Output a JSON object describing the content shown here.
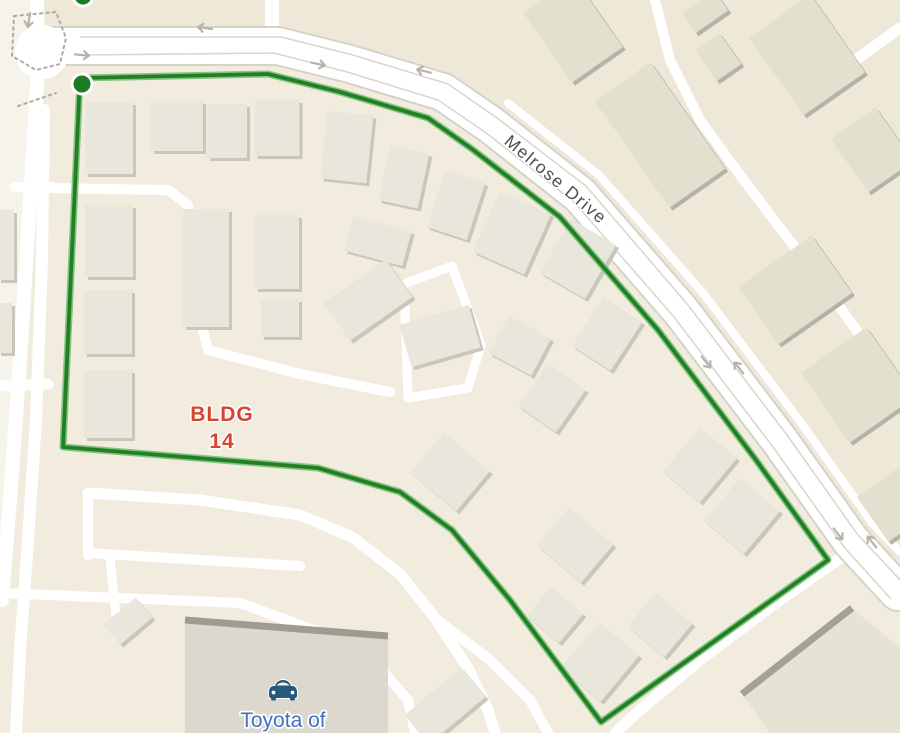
{
  "map": {
    "labels": {
      "street": {
        "text": "Melrose Drive"
      },
      "building_line1": "BLDG",
      "building_line2": "14",
      "poi": "Toyota of"
    },
    "colors": {
      "base": "#f2ecdf",
      "parcel_ne": "#eee8d9",
      "parcel_left": "#f6f3ea",
      "road_fill": "#ffffff",
      "road_casing": "#d5d2c7",
      "lane_line": "#dad7cd",
      "building_fill": "#e9e6db",
      "building_shadow": "#c9c6ba",
      "building_ne_fill": "#e4e0d0",
      "building_ne_shadow": "#b6b3a6",
      "big_building_fill": "#dcd8cd",
      "big_building_edge": "#9e9c92",
      "parking_fill": "#e6e2d4",
      "parking_edge": "#a3a198",
      "route_core": "#237f23",
      "route_halo": "#82c482",
      "marker_fill": "#1d7c21",
      "marker_ring": "#ffffff",
      "arrow": "#b5b3ab",
      "crosswalk": "#adaba1",
      "street_text": "#4f4f4f",
      "bldg_text": "#d5452f",
      "poi_text": "#4170c4",
      "car_icon": "#265a7d"
    },
    "parcels": [
      {
        "fill": "parcel_ne",
        "pts": [
          [
            40,
            0
          ],
          [
            40,
            28
          ],
          [
            281,
            28
          ],
          [
            355,
            46
          ],
          [
            450,
            75
          ],
          [
            500,
            108
          ],
          [
            590,
            177
          ],
          [
            690,
            296
          ],
          [
            790,
            426
          ],
          [
            860,
            526
          ],
          [
            900,
            576
          ],
          [
            900,
            0
          ]
        ]
      },
      {
        "fill": "parcel_left",
        "pts": [
          [
            0,
            0
          ],
          [
            36,
            0
          ],
          [
            30,
            300
          ],
          [
            14,
            500
          ],
          [
            0,
            566
          ]
        ]
      }
    ],
    "roads_minor": [
      {
        "pts": [
          [
            37,
            0
          ],
          [
            38,
            70
          ],
          [
            30,
            200
          ],
          [
            20,
            360
          ],
          [
            10,
            500
          ],
          [
            2,
            600
          ]
        ],
        "w": 14
      },
      {
        "pts": [
          [
            44,
            110
          ],
          [
            42,
            260
          ],
          [
            36,
            420
          ],
          [
            28,
            540
          ],
          [
            20,
            650
          ],
          [
            16,
            733
          ]
        ],
        "w": 12
      },
      {
        "pts": [
          [
            14,
            187
          ],
          [
            52,
            187
          ]
        ],
        "w": 10
      },
      {
        "pts": [
          [
            0,
            386
          ],
          [
            48,
            384
          ]
        ],
        "w": 11
      },
      {
        "pts": [
          [
            48,
            188
          ],
          [
            168,
            190
          ],
          [
            188,
            205
          ],
          [
            195,
            300
          ],
          [
            208,
            350
          ],
          [
            300,
            374
          ],
          [
            390,
            392
          ]
        ],
        "w": 10
      },
      {
        "pts": [
          [
            404,
            284
          ],
          [
            452,
            266
          ],
          [
            481,
            345
          ],
          [
            468,
            388
          ],
          [
            408,
            398
          ],
          [
            404,
            284
          ]
        ],
        "w": 9
      },
      {
        "pts": [
          [
            272,
            0
          ],
          [
            272,
            34
          ]
        ],
        "w": 14
      },
      {
        "pts": [
          [
            88,
            493
          ],
          [
            200,
            500
          ],
          [
            300,
            515
          ],
          [
            352,
            537
          ],
          [
            400,
            574
          ],
          [
            435,
            618
          ],
          [
            468,
            668
          ],
          [
            488,
            710
          ],
          [
            495,
            733
          ]
        ],
        "w": 11
      },
      {
        "pts": [
          [
            435,
            618
          ],
          [
            490,
            660
          ],
          [
            530,
            700
          ],
          [
            548,
            733
          ]
        ],
        "w": 10
      },
      {
        "pts": [
          [
            0,
            593
          ],
          [
            240,
            603
          ],
          [
            330,
            636
          ],
          [
            380,
            668
          ],
          [
            408,
            700
          ],
          [
            415,
            733
          ]
        ],
        "w": 10
      },
      {
        "pts": [
          [
            88,
            493
          ],
          [
            88,
            555
          ]
        ],
        "w": 10
      },
      {
        "pts": [
          [
            88,
            553
          ],
          [
            300,
            566
          ]
        ],
        "w": 10
      },
      {
        "pts": [
          [
            110,
            558
          ],
          [
            118,
            635
          ]
        ],
        "w": 9
      },
      {
        "pts": [
          [
            655,
            0
          ],
          [
            670,
            60
          ],
          [
            700,
            120
          ],
          [
            740,
            175
          ],
          [
            780,
            228
          ],
          [
            822,
            282
          ],
          [
            862,
            338
          ],
          [
            893,
            390
          ]
        ],
        "w": 10
      },
      {
        "pts": [
          [
            828,
            80
          ],
          [
            900,
            28
          ]
        ],
        "w": 11
      },
      {
        "pts": [
          [
            848,
            553
          ],
          [
            780,
            600
          ],
          [
            700,
            660
          ],
          [
            640,
            710
          ],
          [
            615,
            733
          ]
        ],
        "w": 11
      },
      {
        "pts": [
          [
            508,
            103
          ],
          [
            599,
            175
          ],
          [
            703,
            293
          ],
          [
            802,
            424
          ],
          [
            873,
            524
          ],
          [
            900,
            552
          ]
        ],
        "w": 8
      }
    ],
    "corridor": {
      "center": [
        [
          40,
          46
        ],
        [
          278,
          46
        ],
        [
          350,
          64
        ],
        [
          443,
          92
        ],
        [
          491,
          125
        ],
        [
          580,
          195
        ],
        [
          681,
          311
        ],
        [
          780,
          441
        ],
        [
          851,
          541
        ],
        [
          898,
          592
        ]
      ],
      "lane_in": [
        [
          80,
          55
        ],
        [
          274,
          53
        ],
        [
          347,
          72
        ],
        [
          438,
          100
        ],
        [
          485,
          132
        ],
        [
          574,
          202
        ],
        [
          674,
          317
        ],
        [
          773,
          447
        ],
        [
          844,
          547
        ],
        [
          891,
          599
        ]
      ],
      "lane_out": [
        [
          80,
          37
        ],
        [
          281,
          37
        ],
        [
          353,
          55
        ],
        [
          448,
          84
        ],
        [
          497,
          118
        ],
        [
          586,
          186
        ],
        [
          688,
          305
        ],
        [
          787,
          435
        ],
        [
          858,
          535
        ],
        [
          905,
          585
        ]
      ],
      "casing_w": 40,
      "fill_w": 36
    },
    "intersection_patch": {
      "x": 42,
      "y": 52,
      "r": 27
    },
    "crosswalks": [
      "M14,16 L56,12 L66,38 L60,64 L36,70 L12,56 Z",
      "M18,106 L56,93"
    ],
    "special_buildings": {
      "dealership": {
        "poly": [
          [
            185,
            620
          ],
          [
            388,
            636
          ],
          [
            388,
            733
          ],
          [
            185,
            733
          ]
        ],
        "edge": [
          [
            185,
            620
          ],
          [
            388,
            636
          ]
        ]
      },
      "parking": {
        "poly": [
          [
            742,
            694
          ],
          [
            852,
            608
          ],
          [
            900,
            648
          ],
          [
            900,
            733
          ],
          [
            770,
            733
          ]
        ],
        "edge": [
          [
            742,
            694
          ],
          [
            852,
            608
          ]
        ]
      }
    },
    "buildings": [
      [
        109,
        138,
        48,
        72,
        0,
        0
      ],
      [
        177,
        126,
        52,
        50,
        0,
        0
      ],
      [
        227,
        131,
        40,
        54,
        0,
        0
      ],
      [
        277,
        128,
        45,
        56,
        0,
        0
      ],
      [
        347,
        147,
        46,
        68,
        6,
        0
      ],
      [
        404,
        177,
        40,
        56,
        12,
        0
      ],
      [
        456,
        205,
        42,
        60,
        18,
        0
      ],
      [
        512,
        233,
        56,
        66,
        24,
        0
      ],
      [
        578,
        259,
        52,
        62,
        30,
        0
      ],
      [
        607,
        334,
        46,
        58,
        33,
        0
      ],
      [
        109,
        241,
        48,
        72,
        0,
        0
      ],
      [
        108,
        322,
        48,
        64,
        0,
        0
      ],
      [
        108,
        404,
        48,
        68,
        0,
        0
      ],
      [
        206,
        268,
        46,
        118,
        0,
        0
      ],
      [
        277,
        252,
        44,
        74,
        0,
        0
      ],
      [
        280,
        318,
        38,
        38,
        0,
        0
      ],
      [
        378,
        241,
        60,
        36,
        15,
        0
      ],
      [
        368,
        300,
        76,
        46,
        -35,
        0
      ],
      [
        440,
        336,
        72,
        44,
        -16,
        0
      ],
      [
        520,
        346,
        48,
        42,
        28,
        0
      ],
      [
        552,
        398,
        46,
        52,
        35,
        0
      ],
      [
        700,
        465,
        48,
        58,
        40,
        0
      ],
      [
        742,
        516,
        52,
        56,
        40,
        0
      ],
      [
        575,
        545,
        58,
        50,
        40,
        0
      ],
      [
        450,
        472,
        60,
        52,
        40,
        0
      ],
      [
        555,
        615,
        42,
        38,
        40,
        0
      ],
      [
        600,
        662,
        52,
        60,
        40,
        0
      ],
      [
        660,
        625,
        48,
        44,
        40,
        0
      ],
      [
        573,
        30,
        62,
        85,
        -35,
        1
      ],
      [
        660,
        135,
        68,
        130,
        -35,
        1
      ],
      [
        807,
        55,
        75,
        95,
        -35,
        1
      ],
      [
        872,
        150,
        55,
        65,
        -35,
        1
      ],
      [
        718,
        57,
        30,
        38,
        -35,
        1
      ],
      [
        705,
        12,
        40,
        24,
        -35,
        1
      ],
      [
        795,
        290,
        90,
        70,
        -35,
        1
      ],
      [
        858,
        385,
        80,
        85,
        -35,
        1
      ],
      [
        893,
        505,
        50,
        55,
        -35,
        1
      ],
      [
        6,
        245,
        16,
        70,
        0,
        2
      ],
      [
        5,
        328,
        14,
        50,
        0,
        2
      ],
      [
        445,
        706,
        74,
        38,
        -40,
        0
      ],
      [
        128,
        621,
        42,
        26,
        -40,
        0
      ]
    ],
    "arrows": [
      [
        29,
        20,
        100
      ],
      [
        82,
        55,
        5
      ],
      [
        205,
        28,
        188
      ],
      [
        318,
        64,
        12
      ],
      [
        424,
        71,
        194
      ],
      [
        706,
        362,
        52
      ],
      [
        739,
        368,
        232
      ],
      [
        838,
        534,
        52
      ],
      [
        872,
        542,
        232
      ]
    ],
    "route": {
      "points": [
        [
          80,
          78
        ],
        [
          268,
          74
        ],
        [
          340,
          92
        ],
        [
          428,
          118
        ],
        [
          472,
          149
        ],
        [
          560,
          217
        ],
        [
          658,
          330
        ],
        [
          756,
          460
        ],
        [
          828,
          560
        ],
        [
          601,
          722
        ],
        [
          510,
          600
        ],
        [
          452,
          530
        ],
        [
          400,
          492
        ],
        [
          318,
          468
        ],
        [
          63,
          447
        ]
      ],
      "closed": true
    },
    "markers": [
      {
        "x": 82,
        "y": 84,
        "r": 10
      },
      {
        "x": 83,
        "y": -4,
        "r": 10
      }
    ]
  }
}
